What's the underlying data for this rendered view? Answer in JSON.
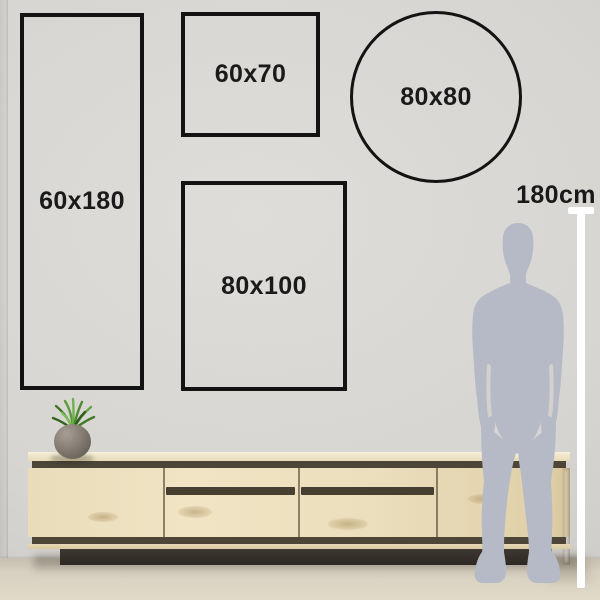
{
  "guide": {
    "description": "wall-art size guide scene",
    "sizes": [
      {
        "shape": "rectangle",
        "label": "60x180"
      },
      {
        "shape": "rectangle",
        "label": "60x70"
      },
      {
        "shape": "circle",
        "label": "80x80"
      },
      {
        "shape": "rectangle",
        "label": "80x100"
      }
    ],
    "height_marker": {
      "label": "180cm"
    }
  },
  "colors": {
    "outline": "#131313",
    "label_text": "#1a1a1a",
    "marker_line": "#ffffff",
    "silhouette": "#b5bac6",
    "wall": "#d7d5d1",
    "wood": "#ecdfbd",
    "groove": "#4c4538",
    "plinth": "#322e28",
    "floor": "#d8d0c0",
    "plant_pot": "#857d73",
    "plant_leaves": "#5d9c3f"
  }
}
